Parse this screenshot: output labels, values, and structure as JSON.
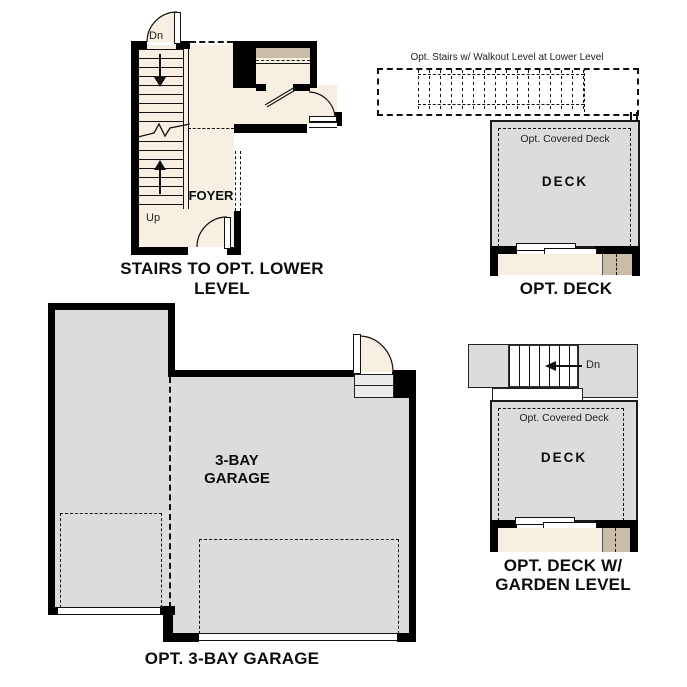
{
  "palette": {
    "floor_beige": "#f6efe2",
    "deck_gray": "#dcdcda",
    "shelf_tan": "#cabda6",
    "wall_black": "#000000",
    "line_color": "#111111",
    "background": "#ffffff"
  },
  "plans": {
    "stairs_lower_level": {
      "caption": "STAIRS TO OPT. LOWER LEVEL",
      "foyer_label": "FOYER",
      "down_label": "Dn",
      "up_label": "Up"
    },
    "opt_deck": {
      "caption": "OPT. DECK",
      "stairs_note": "Opt. Stairs w/ Walkout Level at Lower Level",
      "covered_deck_label": "Opt. Covered Deck",
      "deck_label": "DECK"
    },
    "opt_3bay_garage": {
      "caption": "OPT. 3-BAY GARAGE",
      "label_line1": "3-BAY",
      "label_line2": "GARAGE"
    },
    "opt_deck_garden": {
      "caption_line1": "OPT. DECK W/",
      "caption_line2": "GARDEN LEVEL",
      "covered_deck_label": "Opt. Covered Deck",
      "deck_label": "DECK",
      "down_label": "Dn"
    }
  }
}
